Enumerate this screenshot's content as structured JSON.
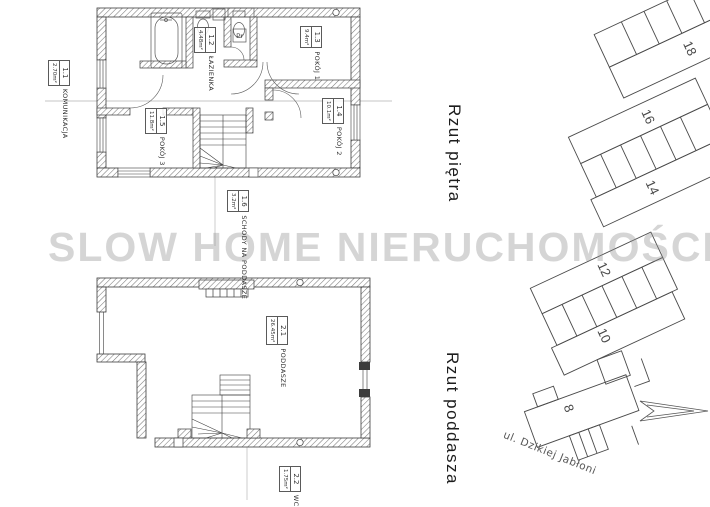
{
  "watermark": "SLOW HOME NIERUCHOMOŚCI",
  "plans": {
    "upper": {
      "title": "Rzut piętra",
      "fixture_label": "Pr",
      "rooms": [
        {
          "id": "1.1",
          "name": "KOMUNIKACJA",
          "area": "2.70m²"
        },
        {
          "id": "1.2",
          "name": "ŁAZIENKA",
          "area": "4.48m²"
        },
        {
          "id": "1.3",
          "name": "POKÓJ 1",
          "area": "9.4m²"
        },
        {
          "id": "1.4",
          "name": "POKÓJ 2",
          "area": "10.1m²"
        },
        {
          "id": "1.5",
          "name": "POKÓJ 3",
          "area": "11.8m²"
        },
        {
          "id": "1.6",
          "name": "SCHODY NA PODDASZE",
          "area": "3.2m²"
        }
      ]
    },
    "attic": {
      "title": "Rzut poddasza",
      "rooms": [
        {
          "id": "2.1",
          "name": "PODDASZE",
          "area": "26.45m²"
        },
        {
          "id": "2.2",
          "name": "WC",
          "area": "1.75m²"
        }
      ]
    }
  },
  "site_plan": {
    "street": "ul. Dzikiej Jabłoni",
    "plot_numbers": [
      "18",
      "16",
      "14",
      "12",
      "10",
      "8"
    ]
  },
  "colors": {
    "background": "#ffffff",
    "line": "#3c3c3c",
    "watermark": "#a9a9a9"
  }
}
